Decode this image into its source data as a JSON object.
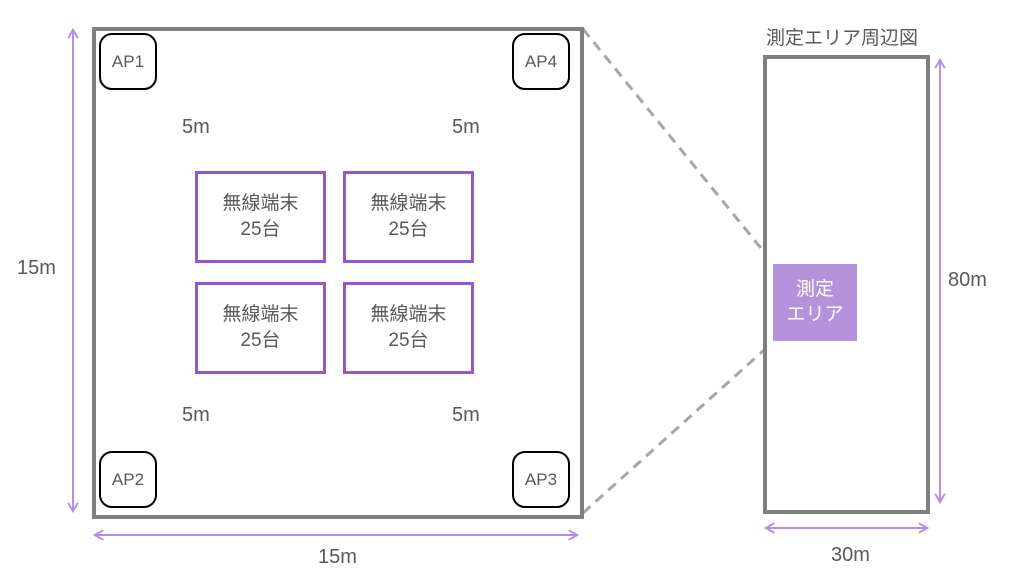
{
  "detail_view": {
    "access_points": [
      {
        "label": "AP1"
      },
      {
        "label": "AP2"
      },
      {
        "label": "AP3"
      },
      {
        "label": "AP4"
      }
    ],
    "terminal_boxes": [
      {
        "line1": "無線端末",
        "line2": "25台"
      },
      {
        "line1": "無線端末",
        "line2": "25台"
      },
      {
        "line1": "無線端末",
        "line2": "25台"
      },
      {
        "line1": "無線端末",
        "line2": "25台"
      }
    ],
    "distance_labels": [
      "5m",
      "5m",
      "5m",
      "5m"
    ],
    "height_label": "15m",
    "width_label": "15m"
  },
  "overview": {
    "title": "測定エリア周辺図",
    "measurement_area": {
      "line1": "測定",
      "line2": "エリア"
    },
    "height_label": "80m",
    "width_label": "30m"
  },
  "colors": {
    "outline_gray": "#7f7f7f",
    "dashed_gray": "#a6a6a6",
    "text_gray": "#595959",
    "terminal_border_purple": "#9355d0",
    "arrow_purple": "#b28ee6",
    "area_fill_purple": "#b593dc",
    "ap_border_black": "#000000"
  }
}
